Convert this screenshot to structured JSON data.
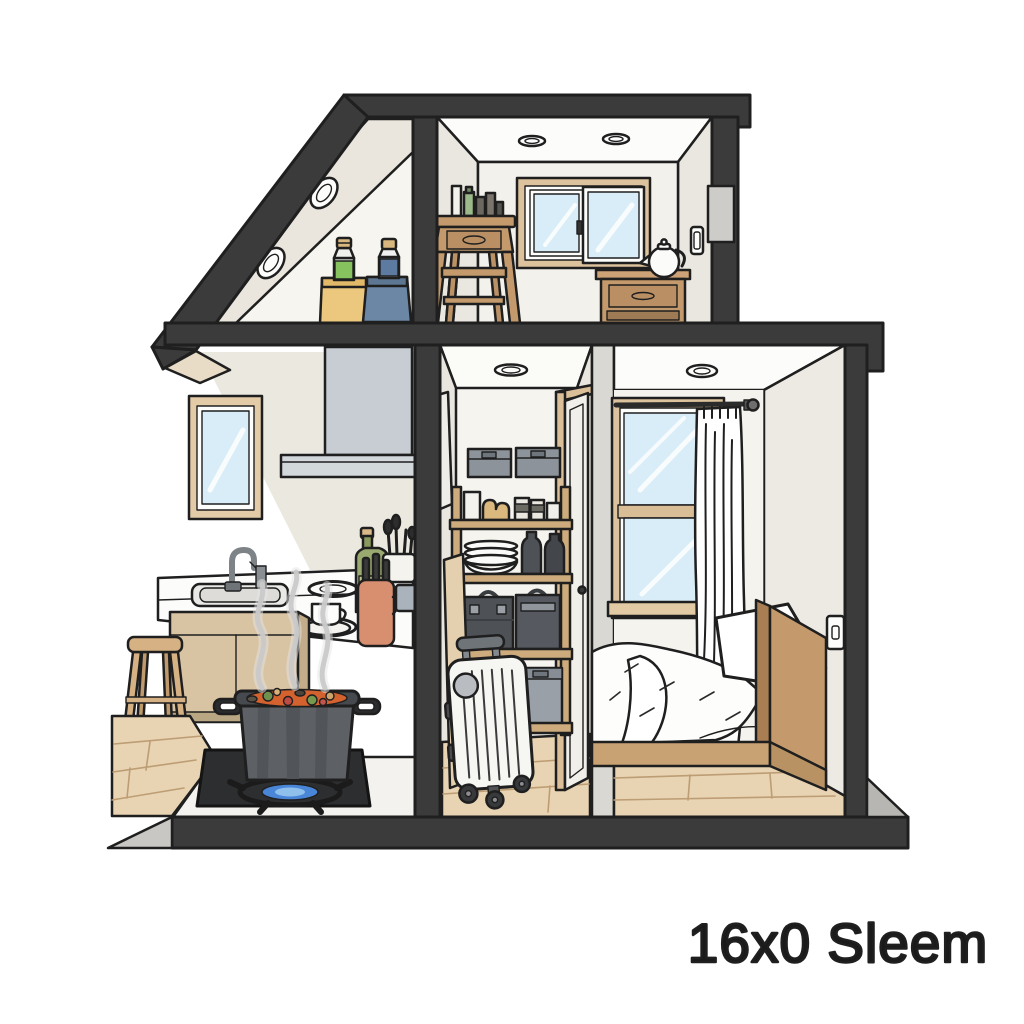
{
  "caption": {
    "text": "16x0 Sleem"
  },
  "palette": {
    "structure": "#3b3b3b",
    "outline": "#1f1f1f",
    "wall_ivory": "#f1eee8",
    "wall_white": "#fcfcfa",
    "wood_frame": "#dcc29d",
    "wood_furniture": "#c49a6c",
    "floor_wood": "#e8d3b3",
    "glass": "#d8edf8",
    "hood_gray": "#c7cdd2",
    "pot_gray": "#5d6165",
    "stew_orange": "#d4622f",
    "flame_blue": "#4a86d8",
    "suitcase_white": "#f6f6f3",
    "bin_gray": "#8d939a",
    "case_dark": "#4e5257",
    "canister_yellow": "#ecc87f",
    "canister_blue": "#6c87a6",
    "bottle_green": "#86c35e",
    "terracotta": "#d88f70",
    "curtain_white": "#ffffff"
  },
  "scene": {
    "type": "cutaway-house-illustration",
    "rooms": [
      {
        "name": "attic-loft",
        "items": [
          "oval-roof-vents",
          "green-bottle-in-yellow-canister",
          "blue-bottle-in-blue-canister"
        ]
      },
      {
        "name": "upper-room",
        "items": [
          "recessed-ceiling-lights",
          "sliding-window",
          "step-stool-with-toiletries",
          "nightstand",
          "kettle",
          "wall-outlet"
        ]
      },
      {
        "name": "kitchen",
        "items": [
          "range-hood",
          "small-window",
          "sink-and-faucet",
          "burners",
          "cup-and-saucer",
          "oil-bottle",
          "utensil-holder",
          "terracotta-crock",
          "mug",
          "cabinets",
          "stool",
          "hot-plate",
          "gas-flame",
          "steaming-stew-pot"
        ]
      },
      {
        "name": "storage-closet",
        "items": [
          "ceiling-light",
          "shelf-unit",
          "storage-bins",
          "jars",
          "plate-stack",
          "dark-flasks",
          "storage-cases",
          "leaning-board",
          "rolling-suitcase",
          "door"
        ]
      },
      {
        "name": "bedroom",
        "items": [
          "ceiling-light",
          "window",
          "curtain-rod",
          "curtain",
          "bed-with-duvet",
          "pillows",
          "wooden-headboard",
          "light-switch"
        ]
      }
    ]
  }
}
